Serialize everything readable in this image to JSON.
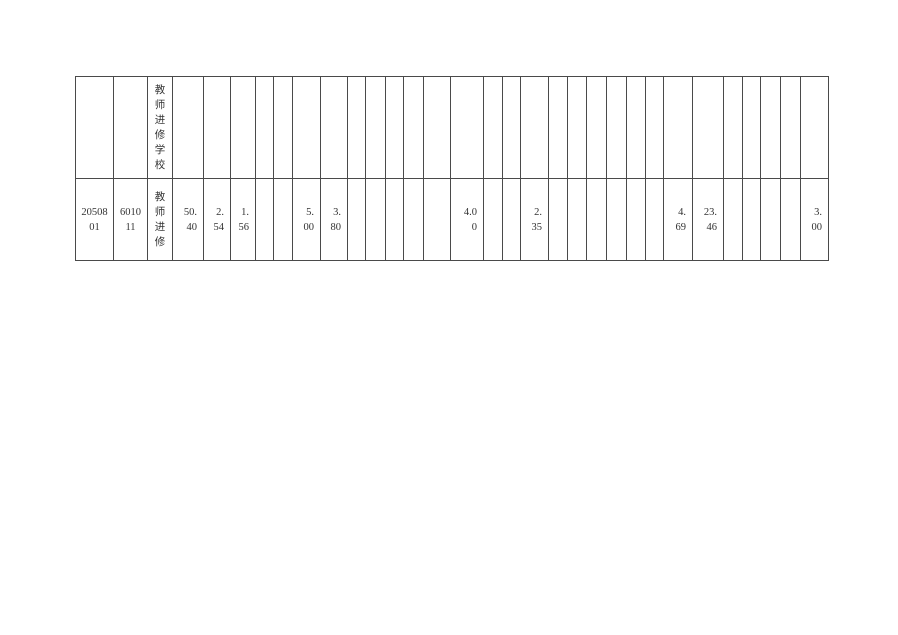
{
  "document": {
    "background_color": "#ffffff",
    "table": {
      "border_color": "#4a4a4a",
      "text_color": "#333333",
      "column_count": 32,
      "rows": [
        {
          "name": "carryover-row",
          "cells": [
            {
              "col": 3,
              "value": "教师进修学校",
              "lines": [
                "教",
                "师",
                "进",
                "修",
                "学",
                "校"
              ],
              "vertical": true,
              "valign": "top",
              "align": "center"
            }
          ]
        },
        {
          "name": "data-row",
          "cells": [
            {
              "col": 1,
              "value": "2050801",
              "lines": [
                "20508",
                "01"
              ],
              "align": "center"
            },
            {
              "col": 2,
              "value": "601011",
              "lines": [
                "6010",
                "11"
              ],
              "align": "center"
            },
            {
              "col": 3,
              "value": "教师进修",
              "lines": [
                "教",
                "师",
                "进",
                "修"
              ],
              "vertical": true,
              "align": "center"
            },
            {
              "col": 4,
              "value": "50.40",
              "lines": [
                "50.",
                "40"
              ],
              "align": "right"
            },
            {
              "col": 5,
              "value": "2.54",
              "lines": [
                "2.",
                "54"
              ],
              "align": "right"
            },
            {
              "col": 6,
              "value": "1.56",
              "lines": [
                "1.",
                "56"
              ],
              "align": "right"
            },
            {
              "col": 9,
              "value": "5.00",
              "lines": [
                "5.",
                "00"
              ],
              "align": "right"
            },
            {
              "col": 10,
              "value": "3.80",
              "lines": [
                "3.",
                "80"
              ],
              "align": "right"
            },
            {
              "col": 16,
              "value": "4.00",
              "lines": [
                "4.0",
                "0"
              ],
              "align": "right"
            },
            {
              "col": 19,
              "value": "2.35",
              "lines": [
                "2.",
                "35"
              ],
              "align": "right"
            },
            {
              "col": 26,
              "value": "4.69",
              "lines": [
                "4.",
                "69"
              ],
              "align": "right"
            },
            {
              "col": 27,
              "value": "23.46",
              "lines": [
                "23.",
                "46"
              ],
              "align": "right"
            },
            {
              "col": 32,
              "value": "3.00",
              "lines": [
                "3.",
                "00"
              ],
              "align": "right"
            }
          ]
        }
      ]
    }
  }
}
